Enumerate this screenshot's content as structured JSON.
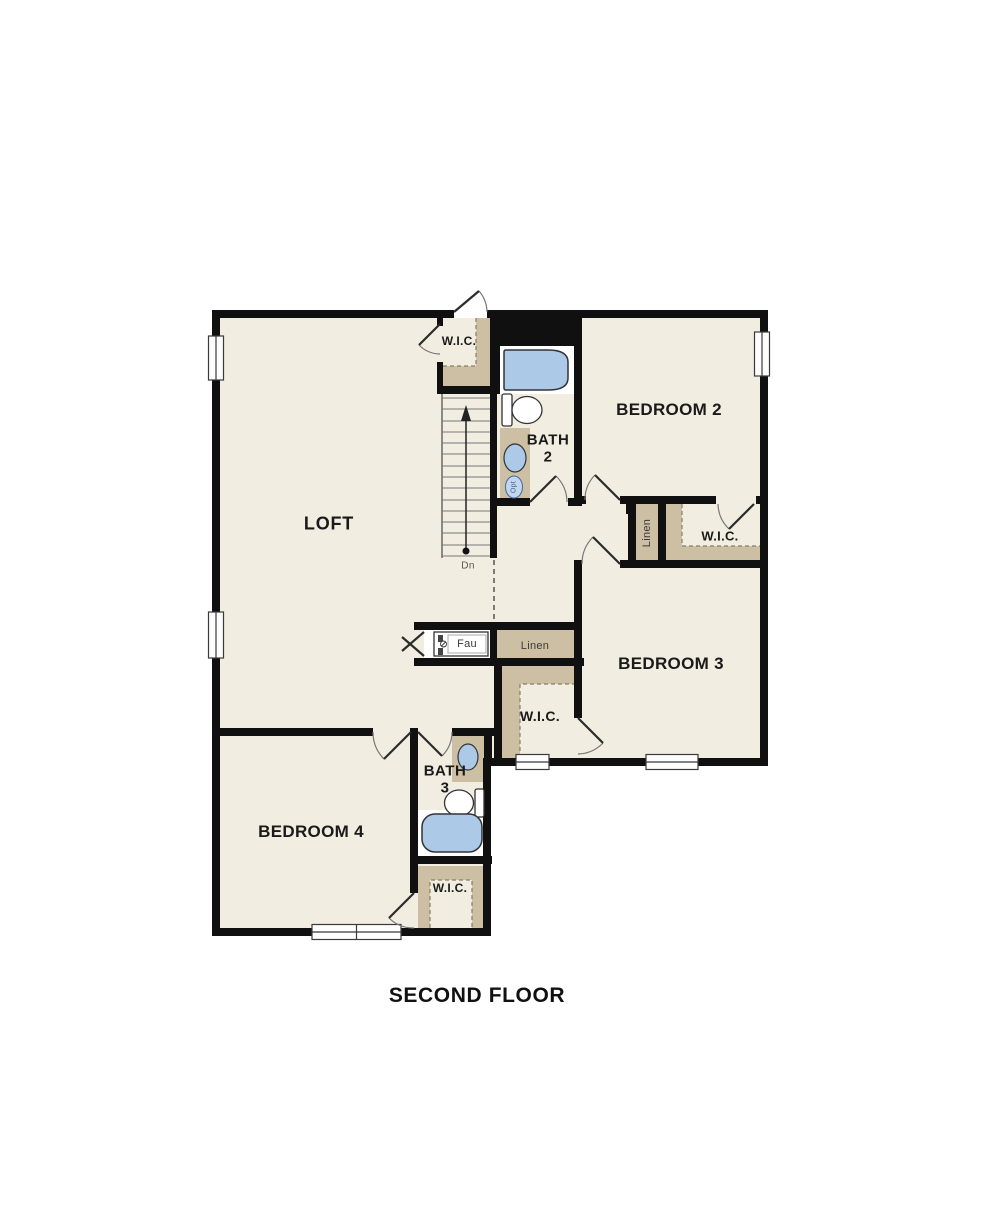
{
  "floor_plan": {
    "title": "SECOND FLOOR",
    "rooms": {
      "loft": "LOFT",
      "bedroom_2": "BEDROOM 2",
      "bedroom_3": "BEDROOM 3",
      "bedroom_4": "BEDROOM 4",
      "bath_2": {
        "line1": "BATH",
        "line2": "2"
      },
      "bath_3": {
        "line1": "BATH",
        "line2": "3"
      },
      "wic_top": "W.I.C.",
      "wic_bedroom_2": "W.I.C.",
      "wic_bedroom_3": "W.I.C.",
      "wic_bedroom_4": "W.I.C.",
      "linen_upper": "Linen",
      "linen_hall": "Linen",
      "fau_closet": "Fau"
    },
    "stairs": {
      "down_label": "Dn"
    },
    "annotations": {
      "optional_fixture": "Opt"
    },
    "colors": {
      "wall": "#101010",
      "floor": "#f2ede1",
      "closet_shelf": "#cdbfa3",
      "fixture_blue": "#adc9e8",
      "background": "#ffffff"
    }
  }
}
